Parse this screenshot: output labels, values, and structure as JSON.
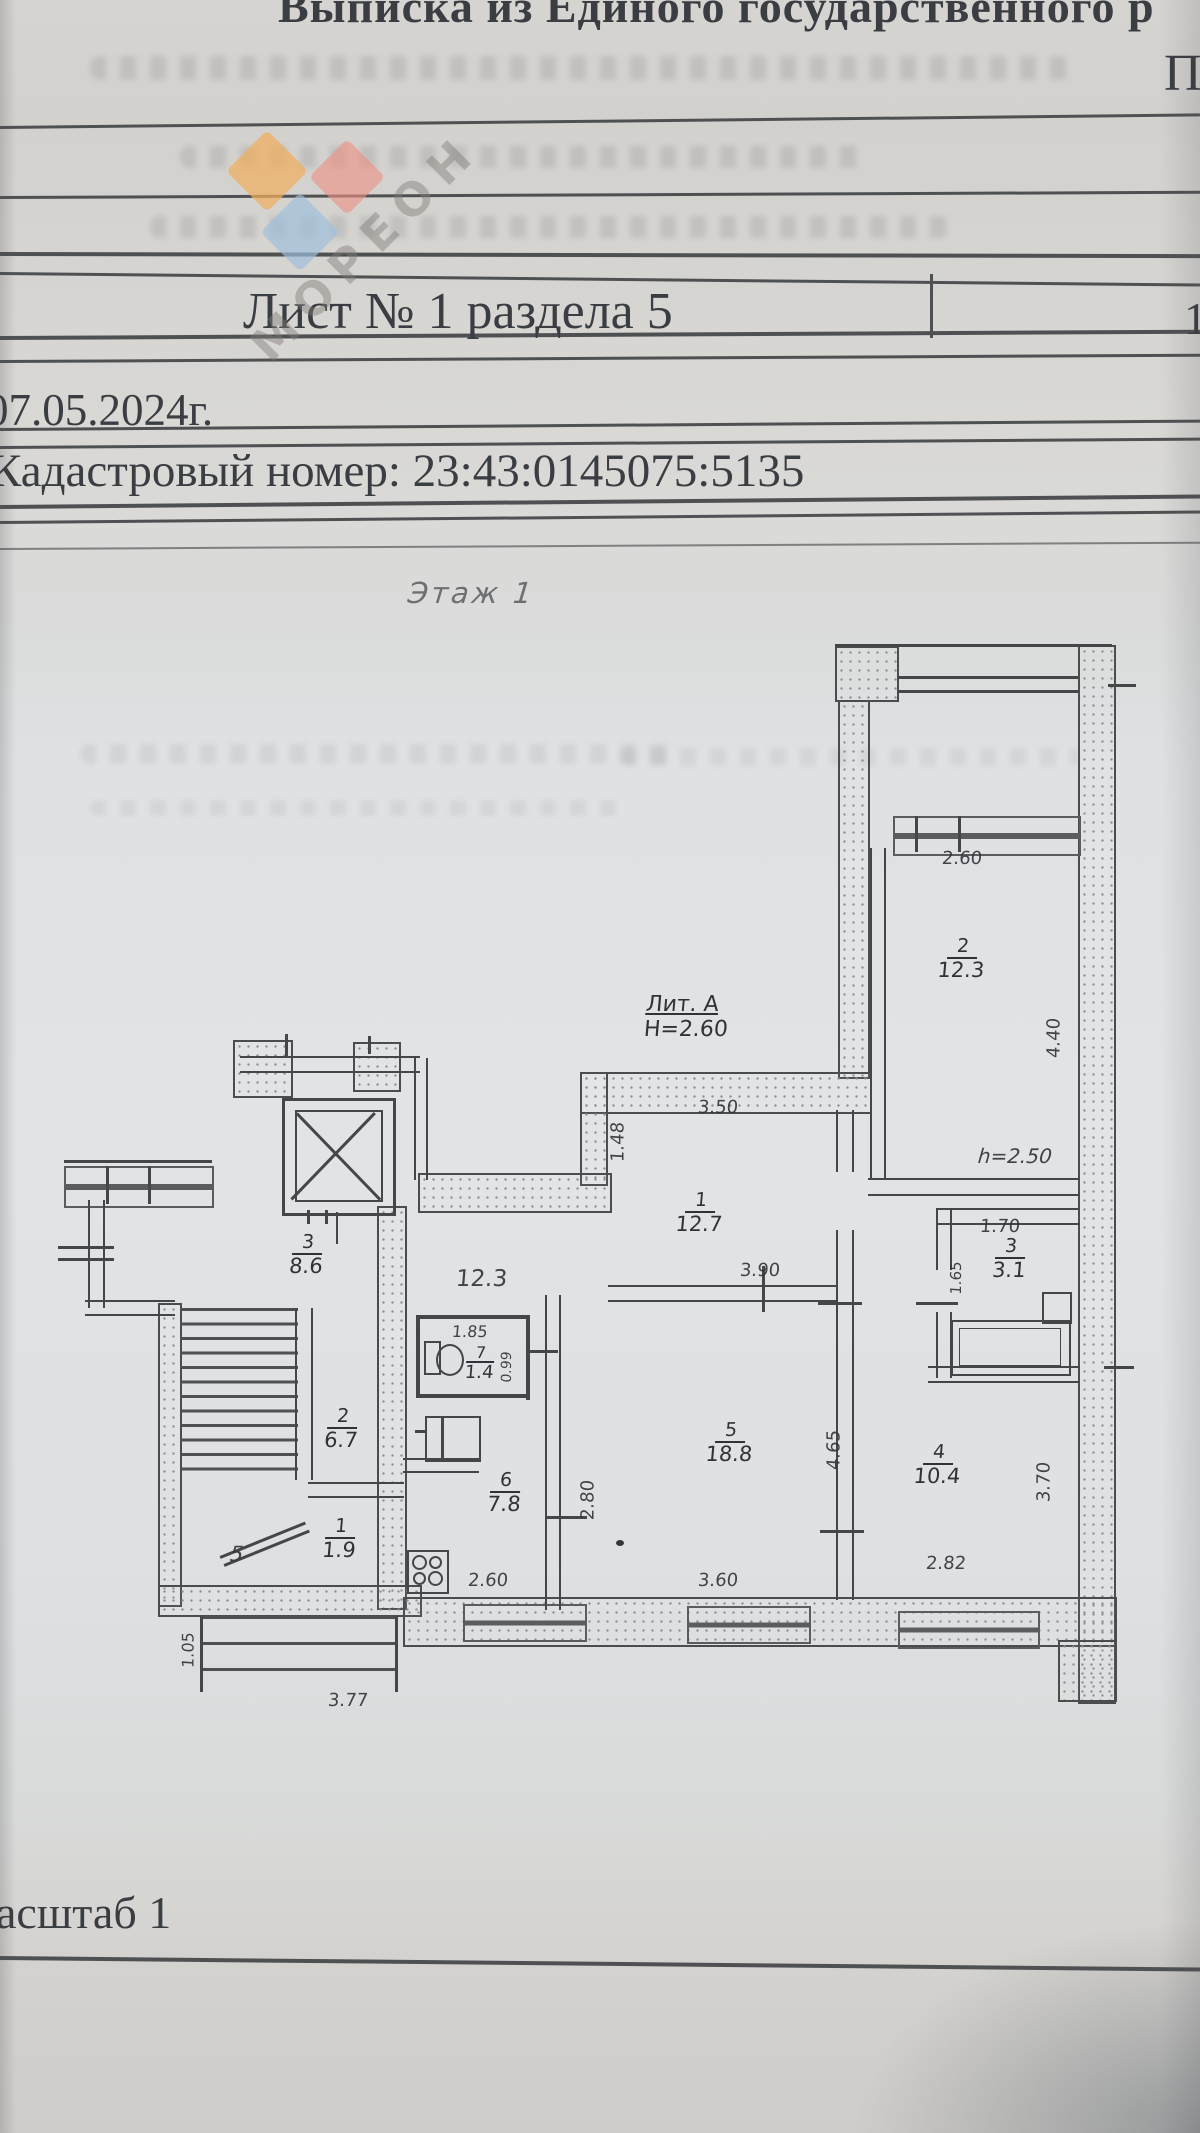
{
  "document": {
    "title_top_partial": "Выписка из Единого государственного р",
    "title_right_partial": "П",
    "sheet_label": "Лист № 1 раздела 5",
    "sheet_right_partial": "1",
    "date_text": "07.05.2024г.",
    "cadastral_text": "Кадастровый номер: 23:43:0145075:5135",
    "floor_title": "Этаж 1",
    "scale_partial": "асштаб 1"
  },
  "watermark": {
    "text": "МОРЕОН",
    "diamond_orange": "#f0af5e",
    "diamond_red": "#ec9184",
    "diamond_blue": "#9dbfdc"
  },
  "plan": {
    "building_litera": "Лит. А",
    "building_height": "Н=2.60",
    "ceiling_note": "h=2.50",
    "corridor_area": "12.3",
    "stair_mark": "5",
    "rooms": [
      {
        "num": "1",
        "area": "12.7"
      },
      {
        "num": "2",
        "area": "12.3"
      },
      {
        "num": "3",
        "area": "8.6"
      },
      {
        "num": "3",
        "area": "3.1"
      },
      {
        "num": "4",
        "area": "10.4"
      },
      {
        "num": "5",
        "area": "18.8"
      },
      {
        "num": "6",
        "area": "7.8"
      },
      {
        "num": "7",
        "area": "1.4"
      },
      {
        "num": "2",
        "area": "6.7"
      },
      {
        "num": "1",
        "area": "1.9"
      }
    ],
    "dims": {
      "win_top": "2.60",
      "room2_depth": "4.40",
      "corridor_top": "3.50",
      "corridor_left": "1.48",
      "room5_top": "3.90",
      "bath_top": "1.70",
      "bath_left": "1.65",
      "wc_top": "1.85",
      "wc_right": "0.99",
      "kitchen_right": "2.80",
      "room5_right": "4.65",
      "room4_right": "3.70",
      "kitchen_win": "2.60",
      "room5_win": "3.60",
      "room4_win": "2.82",
      "porch_left": "1.05",
      "porch_bottom": "3.77"
    }
  }
}
